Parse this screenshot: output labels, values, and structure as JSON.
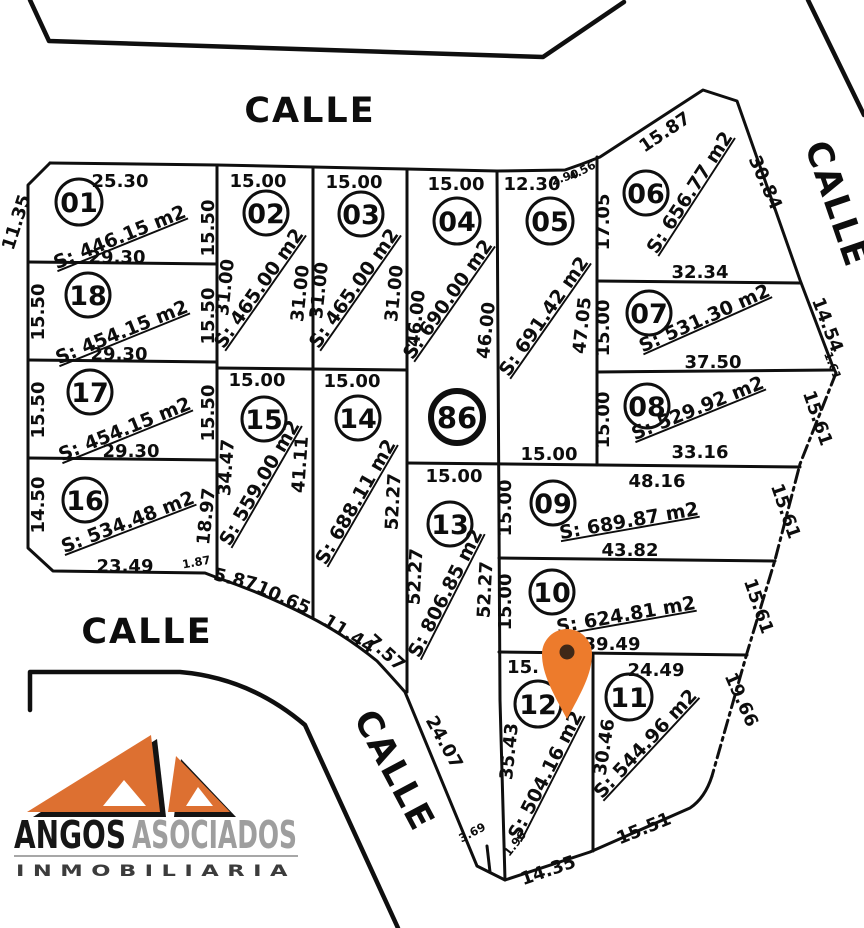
{
  "streets": {
    "top": "CALLE",
    "right": "CALLE",
    "left": "CALLE",
    "diagonal": "CALLE"
  },
  "manzana": {
    "number": "86"
  },
  "marker": {
    "type": "location-pin",
    "fill": "#ED7B2C",
    "dot": "#3F2817"
  },
  "logo": {
    "name": "ANGOS",
    "name2": "ASOCIADOS",
    "subtitle": "INMOBILIARIA",
    "orange": "#DD7031",
    "gray": "#9e9e9e"
  },
  "lots": [
    {
      "num": "01",
      "area": "S: 446.15 m2"
    },
    {
      "num": "02",
      "area": "S: 465.00 m2"
    },
    {
      "num": "03",
      "area": "S: 465.00 m2"
    },
    {
      "num": "04",
      "area": "S: 690.00 m2"
    },
    {
      "num": "05",
      "area": "S: 691.42 m2"
    },
    {
      "num": "06",
      "area": "S: 656.77 m2"
    },
    {
      "num": "07",
      "area": "S: 531.30 m2"
    },
    {
      "num": "08",
      "area": "S: 529.92 m2"
    },
    {
      "num": "09",
      "area": "S: 689.87 m2"
    },
    {
      "num": "10",
      "area": "S: 624.81 m2"
    },
    {
      "num": "11",
      "area": "S: 544.96 m2"
    },
    {
      "num": "12",
      "area": "S: 504.16 m2"
    },
    {
      "num": "13",
      "area": "S: 806.85 m2"
    },
    {
      "num": "14",
      "area": "S: 688.11 m2"
    },
    {
      "num": "15",
      "area": "S: 559.00 m2"
    },
    {
      "num": "16",
      "area": "S: 534.48 m2"
    },
    {
      "num": "17",
      "area": "S: 454.15 m2"
    },
    {
      "num": "18",
      "area": "S: 454.15 m2"
    }
  ],
  "m": {
    "lot01_top": "25.30",
    "lot01_left": "11.35",
    "lot01_right": "15.50",
    "lot01_bottom": "29.30",
    "lot02_top": "15.00",
    "lot02_left": "31.00",
    "lot02_right": "31.00",
    "lot03_top": "15.00",
    "lot03_left": "31.00",
    "lot03_right": "31.00",
    "lot04_top": "15.00",
    "lot04_left": "46.00",
    "lot04_right": "46.00",
    "lot05_top": "12.30",
    "lot05_c1": "2.90",
    "lot05_c2": "4.56",
    "lot05_right": "47.05",
    "lot05_bottom": "15.00",
    "lot06_top": "15.87",
    "lot06_left": "17.05",
    "lot06_right": "30.84",
    "lot06_bottom": "32.34",
    "lot07_left": "15.00",
    "lot07_right": "14.54",
    "lot07_ext": "1.61",
    "lot07_bottom": "37.50",
    "lot08_left": "15.00",
    "lot08_right": "15.61",
    "lot08_bottom": "33.16",
    "lot09_top": "48.16",
    "lot09_left": "15.00",
    "lot09_right": "15.61",
    "lot09_bottom": "43.82",
    "lot10_left": "15.00",
    "lot10_right": "15.61",
    "lot10_bottom": "39.49",
    "lot11_top": "24.49",
    "lot11_left": "30.46",
    "lot11_right": "19.66",
    "lot11_bottom": "15.51",
    "lot12_top": "15.",
    "lot12_left": "35.43",
    "lot12_bottom": "14.35",
    "lot12_ext": "1.96",
    "lot13_top": "15.00",
    "lot13_left": "52.27",
    "lot13_right": "52.27",
    "lot13_street": "24.07",
    "lot13_ext": "3.69",
    "lot14_top": "15.00",
    "lot14_right": "52.27",
    "lot14_b1": "11.44",
    "lot14_b2": "7.57",
    "lot15_top": "15.00",
    "lot15_left": "34.47",
    "lot15_right": "41.11",
    "lot15_b1": "5.87",
    "lot15_b2": "10.65",
    "lot16_left": "14.50",
    "lot16_right": "18.97",
    "lot16_bottom": "23.49",
    "lot16_ext": "1.87",
    "lot17_left": "15.50",
    "lot17_right": "15.50",
    "lot17_bottom": "29.30",
    "lot18_left": "15.50",
    "lot18_right": "15.50",
    "lot18_bottom": "29.30"
  }
}
